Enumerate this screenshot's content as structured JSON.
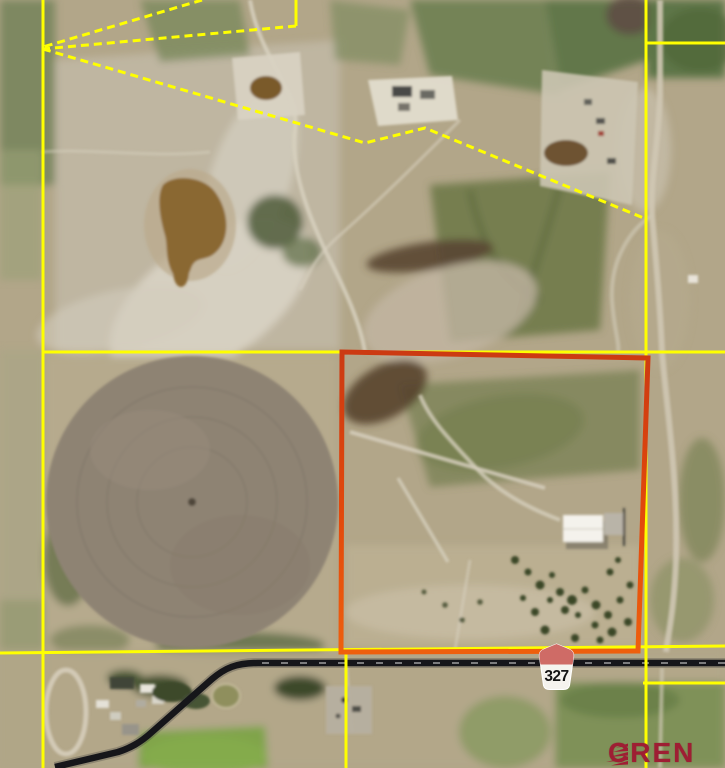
{
  "map": {
    "title": "Aerial parcel map with lot boundary overlay",
    "route_shield": {
      "number": "327",
      "top_color": "#CF6B66",
      "body_color": "#F5F3EE",
      "text_color": "#141414"
    },
    "watermark": {
      "text": "CREN",
      "color": "#9E1E33"
    },
    "overlay": {
      "boundary_color": "#FFFF00",
      "highlight_color": "#E2490C",
      "road_color": "#16161A"
    }
  }
}
